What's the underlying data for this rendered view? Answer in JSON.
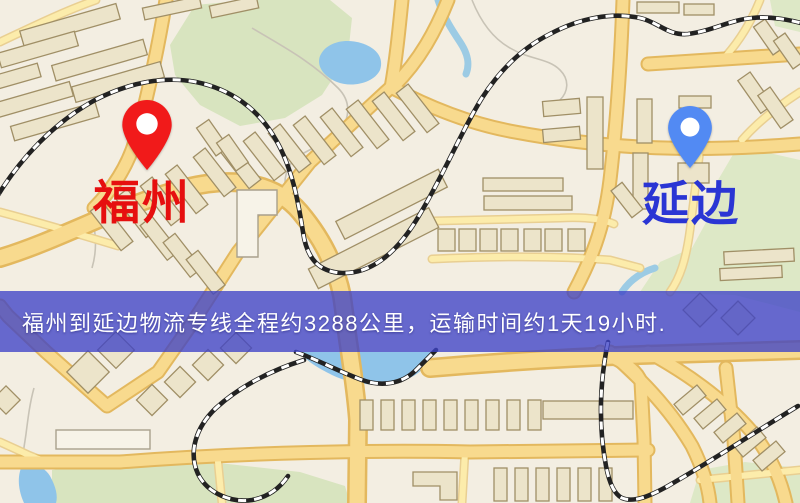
{
  "page": {
    "width": 800,
    "height": 503,
    "kind": "logistics-route-map"
  },
  "map": {
    "description": "stylized city street map",
    "origin_marker": {
      "label": "福州",
      "pin_color": "#f11a1a",
      "label_color": "#e60f0f"
    },
    "destination_marker": {
      "label": "延边",
      "pin_color": "#528af3",
      "label_color": "#2a35d4"
    },
    "terrain_colors": {
      "background": "#f3eee2",
      "road_fill": "#f8da8e",
      "road_casing": "#e3b85e",
      "minor_road": "#fcecab",
      "building": "#ece4ca",
      "park": "#d8e4bf",
      "water": "#8fc4e9",
      "railway": "#222222"
    }
  },
  "banner": {
    "text": "福州到延边物流专线全程约3288公里，运输时间约1天19小时.",
    "background_rgba": "rgba(62,66,198,0.78)",
    "text_color": "#ffffff"
  }
}
